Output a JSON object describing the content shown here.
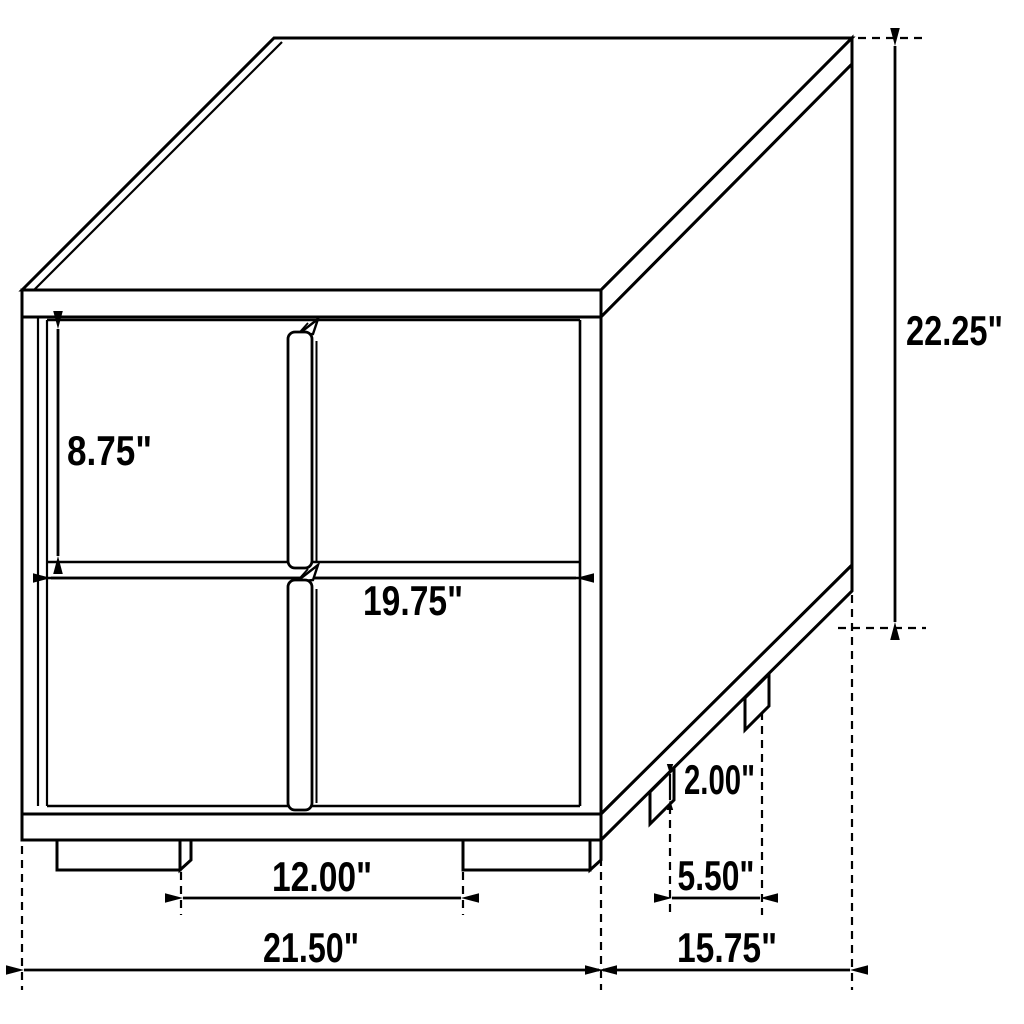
{
  "page": {
    "background_color": "#ffffff",
    "line_color": "#000000"
  },
  "diagram": {
    "subject": "two-drawer nightstand isometric dimension drawing",
    "dimensions": {
      "drawer_height": "8.75\"",
      "drawer_width": "19.75\"",
      "overall_height": "22.25\"",
      "foot_height": "2.00\"",
      "front_feet_gap": "12.00\"",
      "side_feet_gap": "5.50\"",
      "overall_width": "21.50\"",
      "overall_depth": "15.75\""
    }
  }
}
